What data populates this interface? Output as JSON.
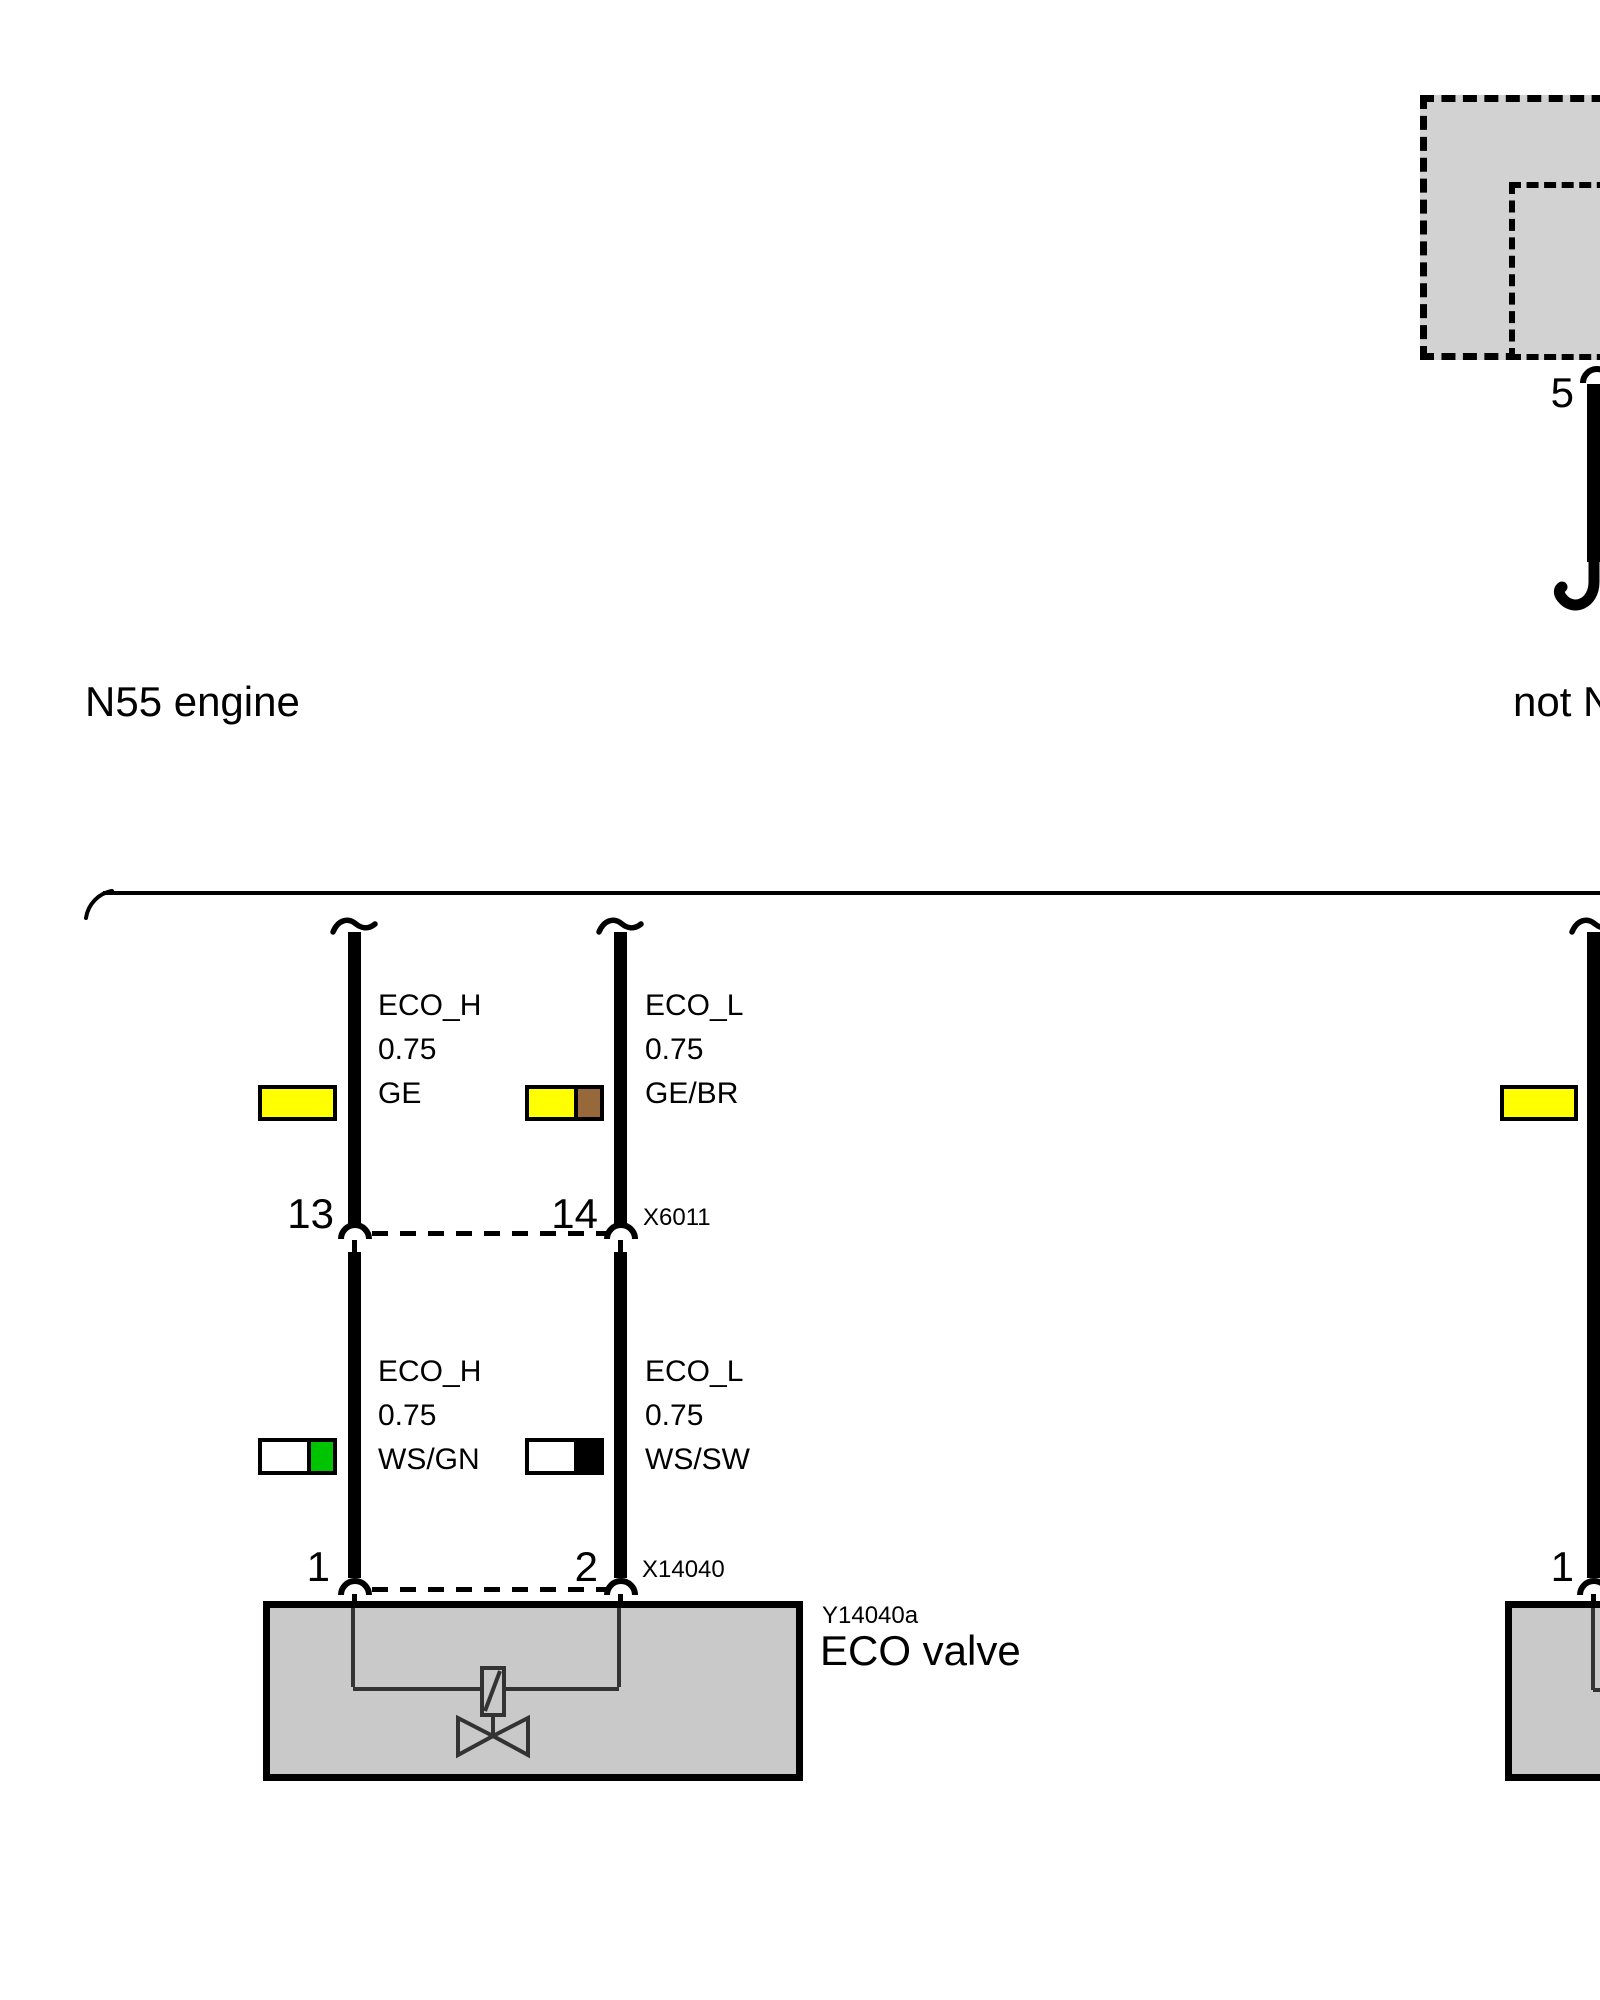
{
  "header": {
    "engine_left": "N55 engine",
    "engine_right": "not N55 engine"
  },
  "control_unit": {
    "pin_label": "5"
  },
  "connectors": {
    "x6011": {
      "id": "X6011",
      "pin_left": "13",
      "pin_right": "14"
    },
    "x14040": {
      "id": "X14040",
      "pin_left": "1",
      "pin_right": "2"
    },
    "right_branch_pin": "1"
  },
  "wires": {
    "upper_left": {
      "signal": "ECO_H",
      "gauge": "0.75",
      "code": "GE",
      "colors": [
        "#ffff00"
      ]
    },
    "upper_right": {
      "signal": "ECO_L",
      "gauge": "0.75",
      "code": "GE/BR",
      "colors": [
        "#ffff00",
        "#96683a"
      ]
    },
    "lower_left": {
      "signal": "ECO_H",
      "gauge": "0.75",
      "code": "WS/GN",
      "colors": [
        "#ffffff",
        "#00c400"
      ]
    },
    "lower_right": {
      "signal": "ECO_L",
      "gauge": "0.75",
      "code": "WS/SW",
      "colors": [
        "#ffffff",
        "#000000"
      ]
    },
    "right_branch": {
      "colors": [
        "#ffff00"
      ]
    }
  },
  "component": {
    "id": "Y14040a",
    "name": "ECO valve"
  },
  "palette": {
    "wire": "#000000",
    "component_fill": "#c9c9c9",
    "control_unit_fill": "#d2d2d2",
    "inner_line": "#333333"
  }
}
